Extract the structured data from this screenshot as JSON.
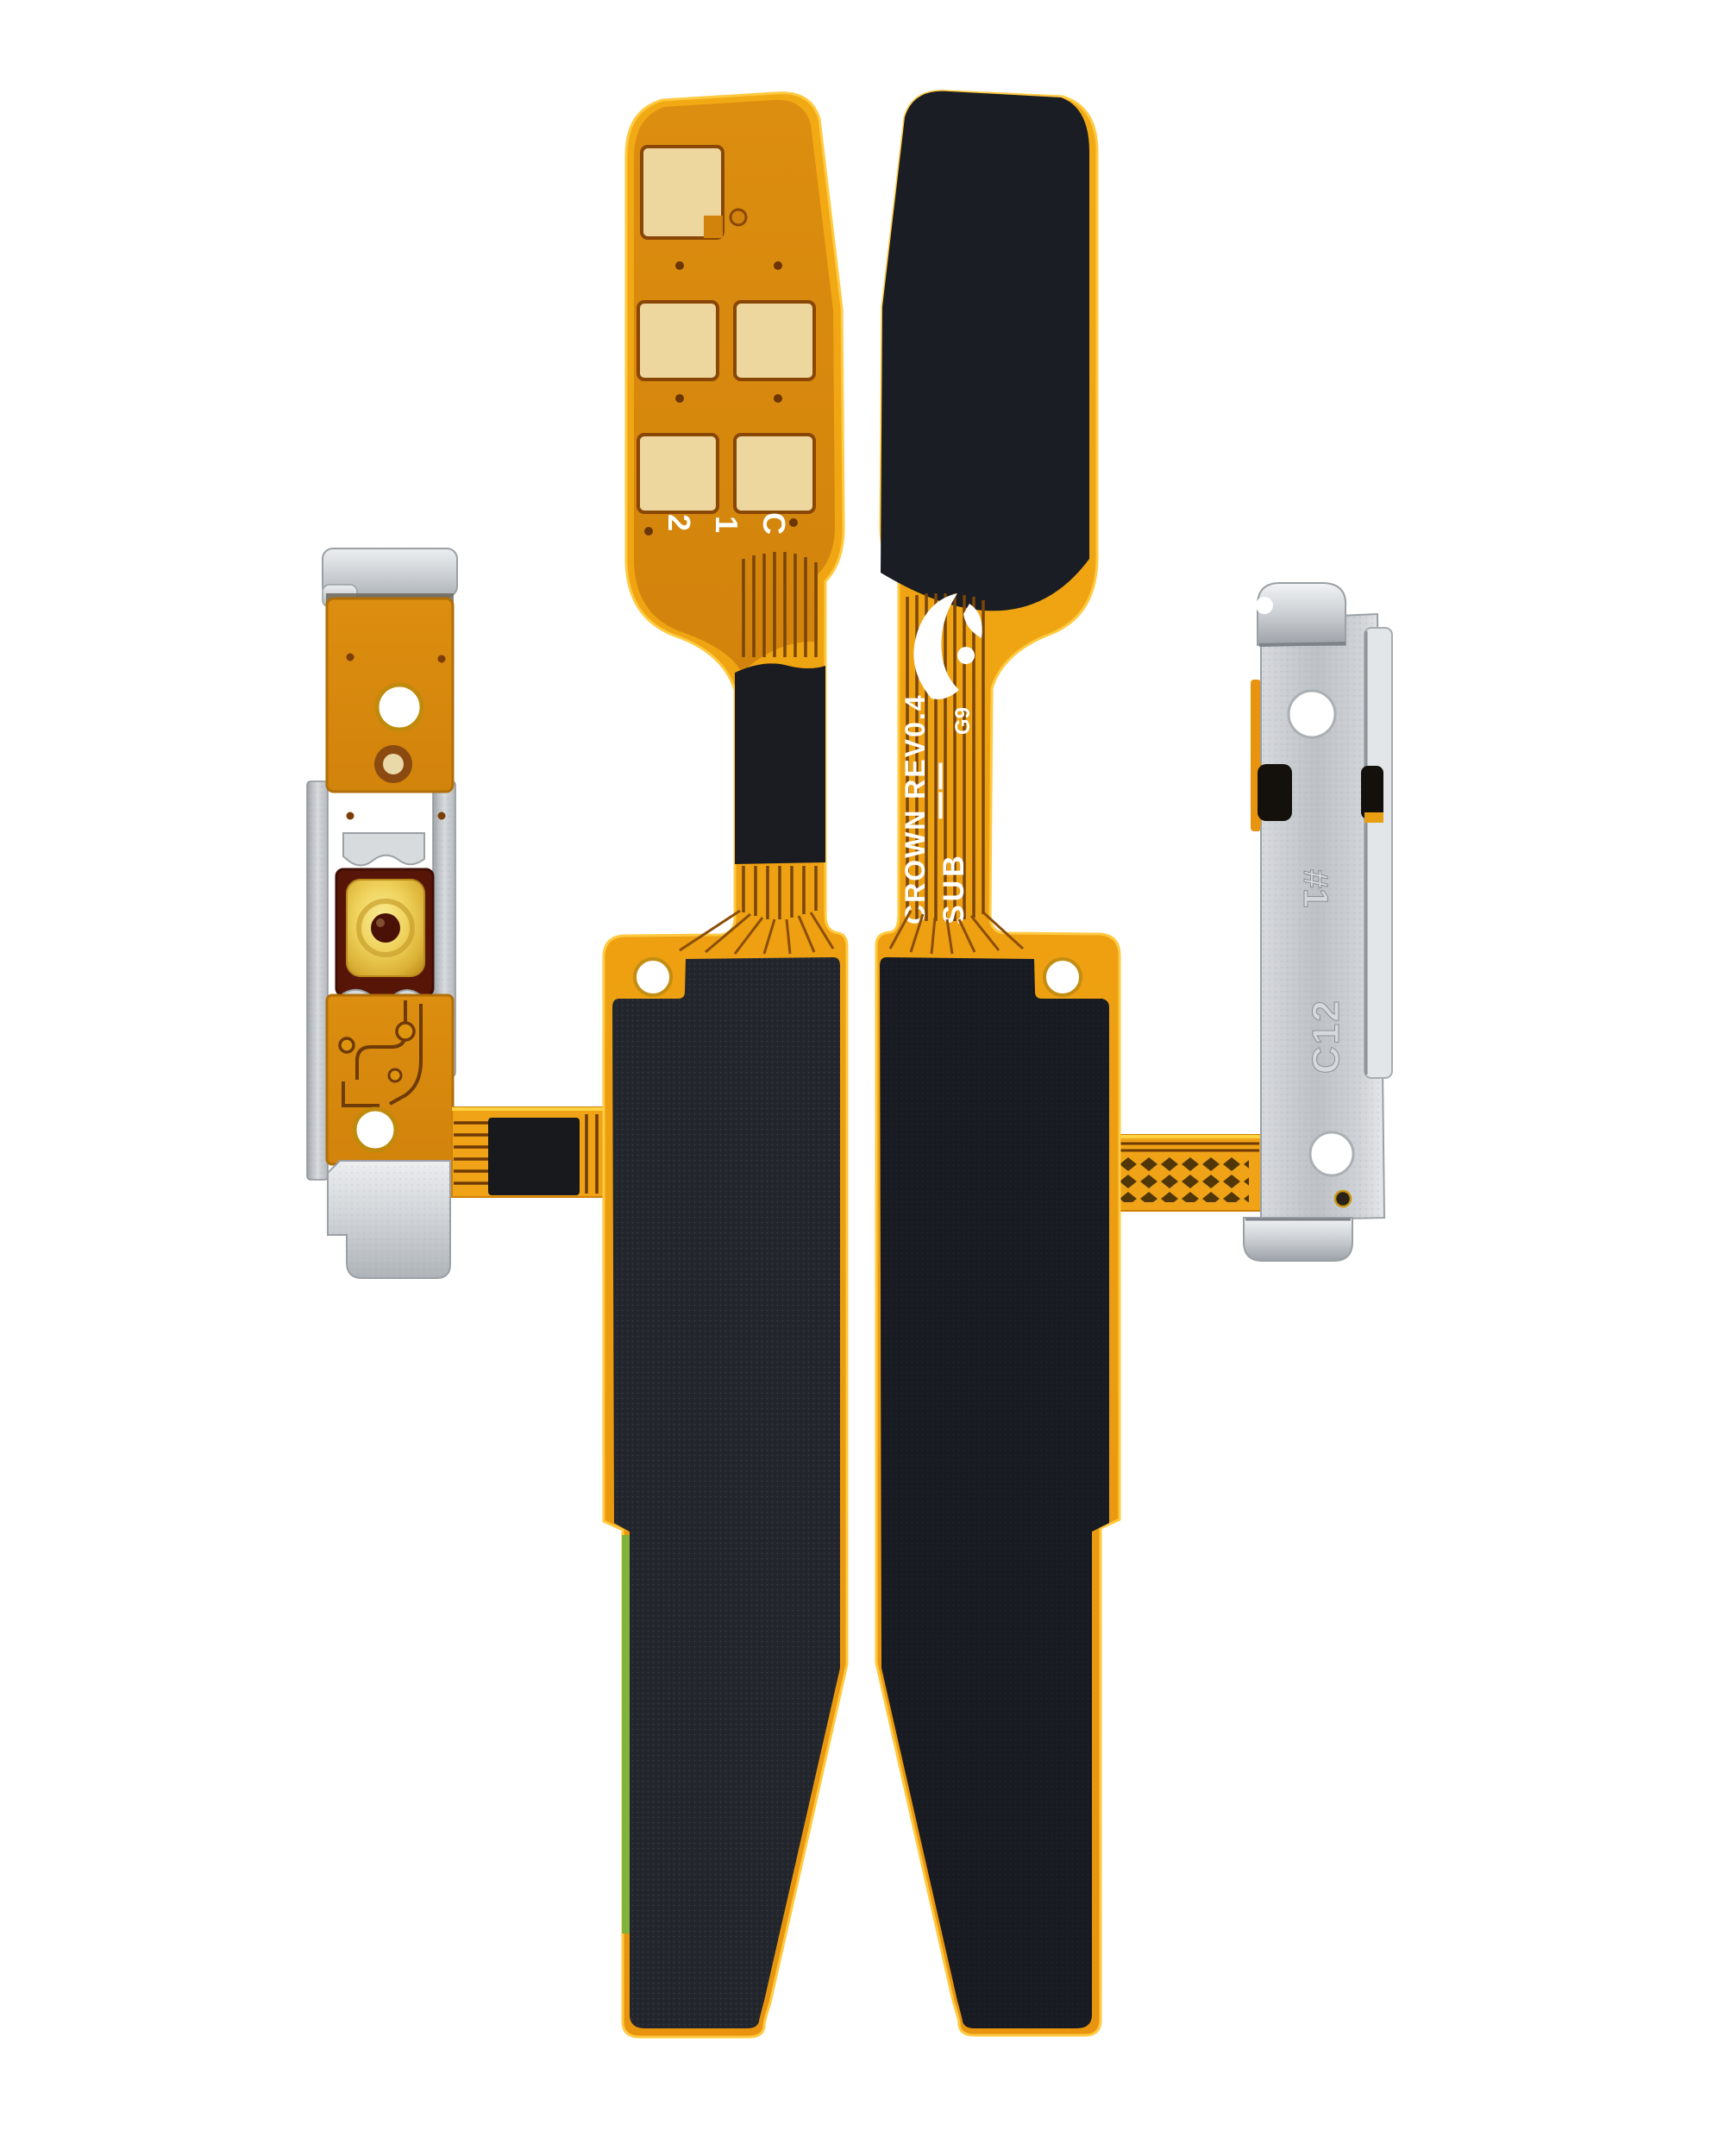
{
  "image": {
    "type": "product-photo",
    "background": "#FFFFFF",
    "subject": "Power button flex cable with dome switch and metal brackets, front and back views"
  },
  "markings": {
    "front_pad_label_1": "2",
    "front_pad_label_2": "1",
    "front_pad_label_3": "C",
    "back_flex_line_1": "CROWN REV0.4",
    "back_flex_line_2": "SUB",
    "back_flex_tick": "|",
    "back_flex_code": "G9",
    "bracket_code_line": "C12",
    "bracket_stamp": "#1"
  },
  "colors": {
    "background": "#FFFFFF",
    "flex_orange": "#E8940E",
    "flex_yellow_edge": "#FFC83D",
    "contact_pad_gold": "#EDD79E",
    "sponge_black": "#1C1F25",
    "metal_silver": "#C9CCD1",
    "button_dome_gold": "#EDC94E",
    "button_housing_maroon": "#571507",
    "pcb_green": "#7FB33C"
  }
}
